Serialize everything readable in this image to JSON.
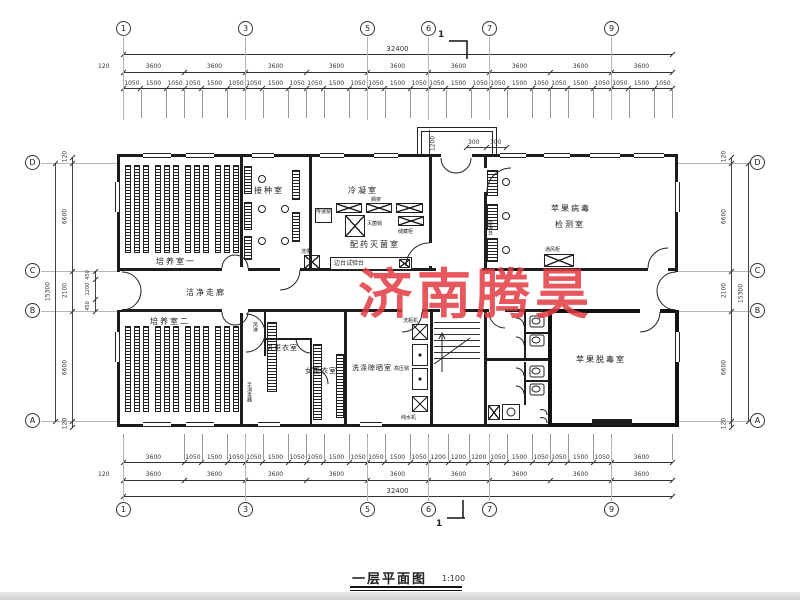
{
  "title": {
    "text": "一层平面图",
    "scale": "1:100"
  },
  "watermark": {
    "text": "济南腾昊",
    "color": "#e23c42"
  },
  "grid": {
    "top": [
      "1",
      "3",
      "5",
      "6",
      "7",
      "9"
    ],
    "bottom": [
      "1",
      "3",
      "5",
      "6",
      "7",
      "9"
    ],
    "left": [
      "D",
      "C",
      "B",
      "A"
    ],
    "right": [
      "D",
      "C",
      "B",
      "A"
    ]
  },
  "section": {
    "mark": "1"
  },
  "dimensions": {
    "top": {
      "overall": "32400",
      "edge": "120",
      "bays": [
        "3600",
        "3600",
        "3600",
        "3600",
        "3600",
        "3600",
        "3600",
        "3600",
        "3600"
      ],
      "sub": [
        "1050",
        "1500",
        "1050",
        "1050",
        "1500",
        "1050",
        "1050",
        "1500",
        "1050",
        "1050",
        "1500",
        "1050",
        "1050",
        "1500",
        "1050",
        "1050",
        "1500",
        "1050",
        "1050",
        "1500",
        "1050",
        "1050",
        "1500",
        "1050",
        "1050",
        "1500",
        "1050"
      ]
    },
    "bottom": {
      "overall": "32400",
      "edge": "120",
      "bays": [
        "3600",
        "3600",
        "3600",
        "3600",
        "3600",
        "3600",
        "3600",
        "3600",
        "3600"
      ],
      "sub": [
        "3600",
        "1050",
        "1500",
        "1050",
        "1050",
        "1500",
        "1050",
        "1050",
        "1500",
        "1050",
        "1050",
        "1500",
        "1050",
        "1200",
        "1200",
        "1200",
        "1050",
        "1500",
        "1050",
        "1050",
        "1500",
        "1050",
        "3600"
      ]
    },
    "left": {
      "overall": "15300",
      "edge_top": "120",
      "upper": "6600",
      "seg_450_a": "450",
      "middle": "2100",
      "inner": "1200",
      "seg_450_b": "450",
      "lower": "6600",
      "edge_bottom": "120"
    },
    "right": {
      "overall": "15300",
      "edge_top": "120",
      "upper": "6600",
      "middle": "2100",
      "lower": "6600",
      "edge_bottom": "120"
    },
    "entrance": {
      "depth": "1200",
      "seg_a": "300",
      "seg_b": "300"
    }
  },
  "rooms": {
    "culture1": "培养室一",
    "inoculation": "接种室",
    "condensation": "冷凝室",
    "prep_sterilization": "配药灭菌室",
    "clean_corridor": "洁净走廊",
    "virus_test_line1": "苹果病毒",
    "virus_test_line2": "检测室",
    "culture2": "培养室二",
    "men_changing": "男更衣室",
    "women_changing": "女更衣室",
    "washing": "洗涤晾晒室",
    "detox": "苹果脱毒室"
  },
  "equipment": {
    "pass_window": "传递窗",
    "shelf": "搁架",
    "sterilizer": "灭菌锅",
    "storage_cabinet": "储藏柜",
    "side_bench": "边台试验台",
    "sink": "洗槽",
    "clean_bench": "超净台",
    "fume_hood": "通风柜",
    "air_shower": "风淋",
    "hand_sanitizer": "手消毒器",
    "bottle_washer": "洗瓶机",
    "autoclave": "高压锅",
    "water_purifier": "纯水机"
  }
}
